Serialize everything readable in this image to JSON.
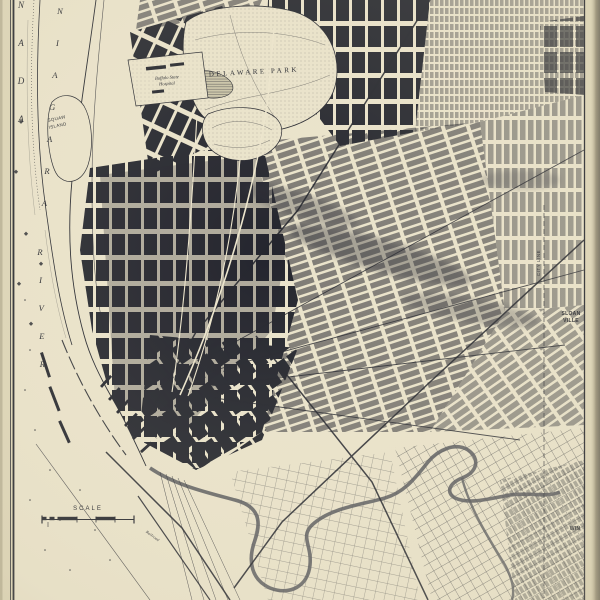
{
  "colors": {
    "paper": "#eae3cb",
    "page_margin": "#ddd5b8",
    "ink": "#24262e",
    "river_shade": "#54555a",
    "park_lake": "#c9c3a8",
    "page_edge": "#716c5e"
  },
  "map": {
    "labels": [
      {
        "id": "scale-title",
        "text": "SCALE",
        "x": 88,
        "y": 510,
        "size": 6,
        "ls": 2,
        "rot": 0,
        "style": "caps"
      },
      {
        "id": "delaware-park",
        "text": "DELAWARE PARK",
        "x": 254,
        "y": 74,
        "size": 7,
        "ls": 2.5,
        "rot": -3,
        "style": "lbl"
      },
      {
        "id": "buffalo-state-hospital-1",
        "text": "Buffalo State",
        "x": 167,
        "y": 79,
        "size": 4.6,
        "ls": 0,
        "rot": -4,
        "style": "italic"
      },
      {
        "id": "buffalo-state-hospital-2",
        "text": "Hospital",
        "x": 167,
        "y": 85,
        "size": 4.6,
        "ls": 0,
        "rot": -4,
        "style": "italic"
      },
      {
        "id": "squaw-island-1",
        "text": "SQUAW",
        "x": 57,
        "y": 120,
        "size": 4.4,
        "ls": 0.4,
        "rot": -12,
        "style": "caps"
      },
      {
        "id": "squaw-island-2",
        "text": "ISLAND",
        "x": 58,
        "y": 127,
        "size": 4.4,
        "ls": 0.4,
        "rot": -12,
        "style": "caps"
      },
      {
        "id": "sloan-1",
        "text": "SLOAN",
        "x": 571,
        "y": 315,
        "size": 5,
        "ls": 0.3,
        "rot": 0,
        "style": "bold"
      },
      {
        "id": "sloan-2",
        "text": "VILLE",
        "x": 571,
        "y": 322,
        "size": 5,
        "ls": 0.3,
        "rot": 0,
        "style": "bold"
      },
      {
        "id": "winchester",
        "text": "WIN",
        "x": 575,
        "y": 530,
        "size": 5,
        "ls": 0.3,
        "rot": 0,
        "style": "bold"
      },
      {
        "id": "city-line",
        "text": "CITY LINE",
        "x": 540,
        "y": 263,
        "size": 4.4,
        "ls": 0.6,
        "rot": -90,
        "style": "caps"
      },
      {
        "id": "railroad",
        "text": "Railroad",
        "x": 152,
        "y": 537,
        "size": 4,
        "ls": 0.2,
        "rot": 36,
        "style": "italic"
      }
    ],
    "vertical_words": [
      {
        "id": "canada",
        "letters": "CANADA",
        "x": 21,
        "y": -68,
        "dx": 0,
        "dy": 38,
        "size": 9
      },
      {
        "id": "niagara",
        "letters": "NIAGARA",
        "x": 60,
        "y": 14,
        "dx": -2.6,
        "dy": 32,
        "size": 8.5
      },
      {
        "id": "river",
        "letters": "RIVER",
        "x": 40,
        "y": 255,
        "dx": 0.6,
        "dy": 28,
        "size": 8.5
      }
    ]
  }
}
